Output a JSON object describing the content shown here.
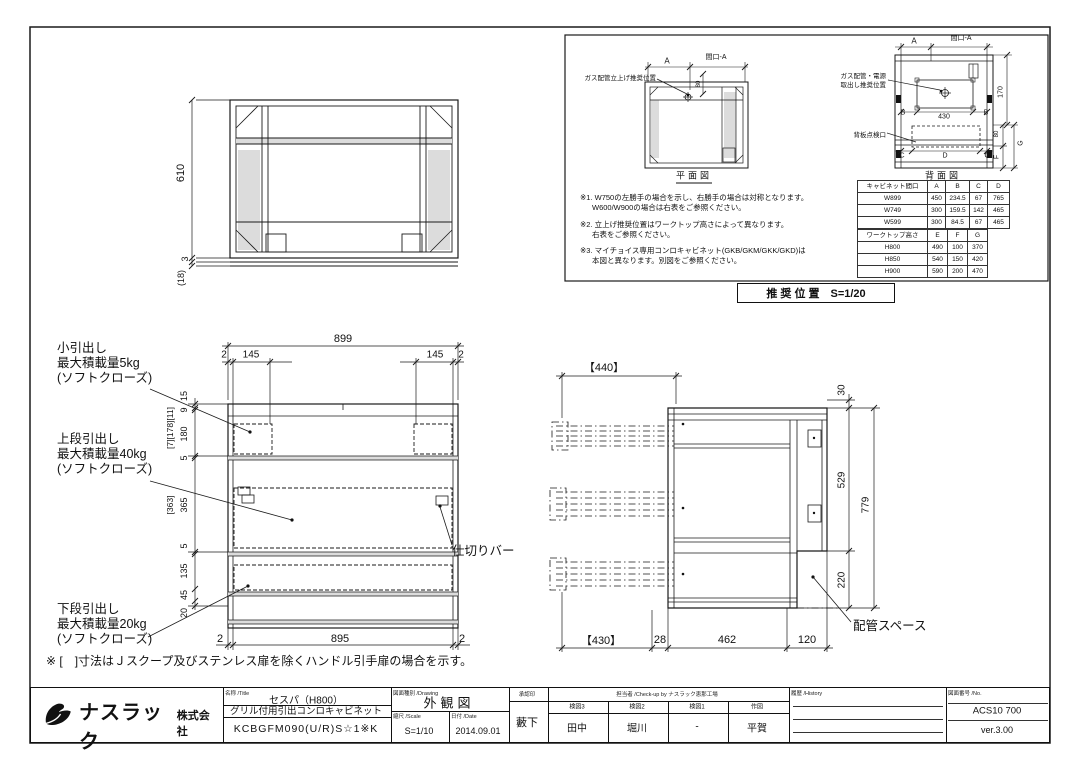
{
  "tv": {
    "d610": "610",
    "d3": "3",
    "d18": "(18)"
  },
  "fv": {
    "d899": "899",
    "d2a": "2",
    "d145a": "145",
    "d145b": "145",
    "d2b": "2",
    "left": [
      "15",
      "9",
      "180",
      "5",
      "365",
      "5",
      "135",
      "45",
      "20"
    ],
    "alt1": "[7][178][11]",
    "alt2": "[363]",
    "bottom": [
      "2",
      "895",
      "2"
    ],
    "lbl_small": [
      "小引出し",
      "最大積載量5kg",
      "(ソフトクローズ)"
    ],
    "lbl_upper": [
      "上段引出し",
      "最大積載量40kg",
      "(ソフトクローズ)"
    ],
    "lbl_lower": [
      "下段引出し",
      "最大積載量20kg",
      "(ソフトクローズ)"
    ],
    "lbl_divider": "仕切りバー"
  },
  "sv": {
    "d440": "【440】",
    "d430": "【430】",
    "d28": "28",
    "d462": "462",
    "d120": "120",
    "d30": "30",
    "d529": "529",
    "d220": "220",
    "d779": "779",
    "lbl_pipe": "配管スペース"
  },
  "panel": {
    "plan": {
      "a": "A",
      "mouth": "間口-A",
      "d80": "80",
      "gas": "ガス配管立上げ推奨位置",
      "title": "平面図"
    },
    "rear": {
      "a": "A",
      "mouth": "間口-A",
      "d430": "430",
      "b1": "B",
      "b2": "B",
      "c1": "C",
      "dd": "D",
      "c2": "C",
      "d170": "170",
      "d80": "80",
      "g": "G",
      "f": "F",
      "gas1": "ガス配管・電源",
      "gas2": "取出し推奨位置",
      "back": "背板点検口",
      "title": "背面図"
    },
    "notes": [
      [
        "※1. W750の左勝手の場合を示し、右勝手の場合は対称となります。",
        "W600/W900の場合は右表をご参照ください。"
      ],
      [
        "※2. 立上げ推奨位置はワークトップ高さによって異なります。",
        "右表をご参照ください。"
      ],
      [
        "※3. マイチョイス専用コンロキャビネット(GKB/GKM/GKK/GKD)は",
        "本図と異なります。別図をご参照ください。"
      ]
    ],
    "t1": {
      "h": [
        "キャビネット間口",
        "A",
        "B",
        "C",
        "D"
      ],
      "r": [
        [
          "W899",
          "450",
          "234.5",
          "67",
          "765"
        ],
        [
          "W749",
          "300",
          "159.5",
          "142",
          "465"
        ],
        [
          "W599",
          "300",
          "84.5",
          "67",
          "465"
        ]
      ]
    },
    "t2": {
      "h": [
        "ワークトップ高さ",
        "E",
        "F",
        "G"
      ],
      "r": [
        [
          "H800",
          "490",
          "100",
          "370"
        ],
        [
          "H850",
          "540",
          "150",
          "420"
        ],
        [
          "H900",
          "590",
          "200",
          "470"
        ]
      ]
    },
    "rec": "推 奨 位 置　S=1/20"
  },
  "note": "※ [　]寸法はＪスクープ及びステンレス扉を除くハンドル引手扉の場合を示す。",
  "tb": {
    "company": "ナスラック",
    "company2": "株式会社",
    "h_name": "名称 /Title",
    "t1": "セスパ（H800）",
    "t2": "グリル付用引出コンロキャビネット",
    "model": "KCBGFM090(U/R)S☆1※K",
    "h_draw": "図面種別 /Drawing",
    "dtype": "外観図",
    "h_scale": "縮尺 /Scale",
    "scale": "S=1/10",
    "h_date": "日付 /Date",
    "date": "2014.09.01",
    "h_appr": "承認印",
    "appr": "藪下",
    "h_staff": "担当者 /Check-up by ナスラック恵那工場",
    "cols": [
      {
        "h": "検図3",
        "v": "田中"
      },
      {
        "h": "検図2",
        "v": "堀川"
      },
      {
        "h": "検図1",
        "v": "-"
      },
      {
        "h": "作図",
        "v": "平賀"
      }
    ],
    "h_hist": "履歴 /History",
    "h_no": "図面番号 /No.",
    "no": "ACS10 700",
    "ver": "ver.3.00"
  }
}
